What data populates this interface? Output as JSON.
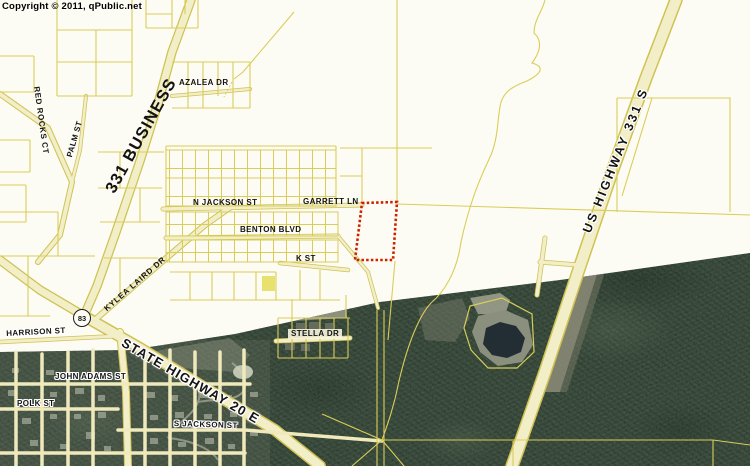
{
  "copyright": "Copyright © 2011, qPublic.net",
  "map": {
    "shield_83": "83",
    "colors": {
      "highlight_red": "#cc2200",
      "parcel_line_yellow": "#d9cd58",
      "road_fill": "#f2eec8",
      "road_edge": "#cfc253",
      "forest_green": "#2e3f32",
      "background": "#fdfcf4"
    },
    "labels": {
      "red_rocks_ct": "RED ROCKS CT",
      "palm_st": "PALM ST",
      "business_331": "331 BUSINESS",
      "azalea_dr": "AZALEA DR",
      "n_jackson_st": "N JACKSON ST",
      "garrett_ln": "GARRETT LN",
      "benton_blvd": "BENTON BLVD",
      "k_st": "K ST",
      "kylea_laird_dr": "KYLEA LAIRD DR",
      "harrison_st": "HARRISON ST",
      "state_highway_20_e": "STATE HIGHWAY 20 E",
      "john_adams_st": "JOHN ADAMS ST",
      "polk_st": "POLK ST",
      "s_jackson_st": "S JACKSON ST",
      "stella_dr": "STELLA DR",
      "us_highway_331_s": "US HIGHWAY 331 S"
    }
  }
}
